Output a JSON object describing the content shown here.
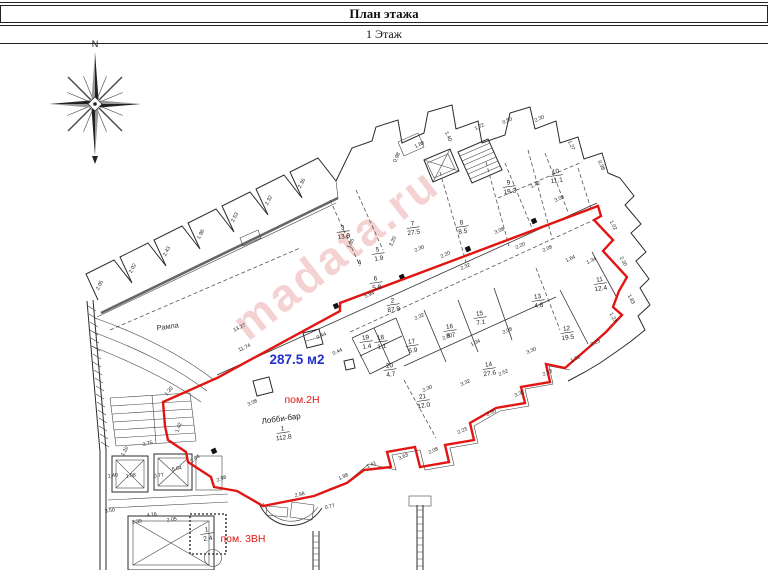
{
  "header": {
    "title": "План этажа",
    "subtitle": "1 Этаж"
  },
  "compass": {
    "north_label": "N"
  },
  "watermark": {
    "text": "madata.ru",
    "color": "rgba(226,118,118,0.33)"
  },
  "highlight": {
    "area_label": "287.5 м2",
    "area_color": "#2431c9",
    "outline_color": "#e11612",
    "label_color": "#e11612",
    "premise_label": "пом.2Н",
    "premise3_label": "пом. 3ВН"
  },
  "plan": {
    "ramp_label": "Рампа",
    "rooms": [
      {
        "num": "1",
        "area": "112.8",
        "x": 283,
        "y": 432,
        "label": "Лобби-бар"
      },
      {
        "num": "2",
        "area": "87.9",
        "x": 393,
        "y": 304
      },
      {
        "num": "3",
        "area": "13.9",
        "x": 343,
        "y": 231
      },
      {
        "num": "4",
        "area": "",
        "x": 360,
        "y": 266
      },
      {
        "num": "5",
        "area": "1.9",
        "x": 378,
        "y": 253
      },
      {
        "num": "6",
        "area": "5.8",
        "x": 376,
        "y": 282
      },
      {
        "num": "7",
        "area": "27.5",
        "x": 413,
        "y": 227
      },
      {
        "num": "8",
        "area": "8.5",
        "x": 462,
        "y": 226
      },
      {
        "num": "9",
        "area": "19.3",
        "x": 509,
        "y": 186
      },
      {
        "num": "10",
        "area": "11.1",
        "x": 556,
        "y": 175
      },
      {
        "num": "11",
        "area": "12.4",
        "x": 600,
        "y": 283
      },
      {
        "num": "12",
        "area": "19.5",
        "x": 567,
        "y": 332
      },
      {
        "num": "13",
        "area": "4.8",
        "x": 538,
        "y": 300
      },
      {
        "num": "14",
        "area": "27.6",
        "x": 489,
        "y": 368
      },
      {
        "num": "15",
        "area": "7.1",
        "x": 480,
        "y": 317
      },
      {
        "num": "16",
        "area": "8.7",
        "x": 450,
        "y": 330
      },
      {
        "num": "17",
        "area": "6.9",
        "x": 412,
        "y": 345
      },
      {
        "num": "18",
        "area": "1.1",
        "x": 381,
        "y": 341
      },
      {
        "num": "19",
        "area": "1.4",
        "x": 366,
        "y": 341
      },
      {
        "num": "20",
        "area": "4.7",
        "x": 390,
        "y": 369
      },
      {
        "num": "21",
        "area": "12.0",
        "x": 423,
        "y": 400
      },
      {
        "num": "1",
        "area": "2.4",
        "x": 207,
        "y": 533
      }
    ],
    "dims": [
      [
        101,
        286,
        "2.05",
        -62
      ],
      [
        134,
        269,
        "2.02",
        -62
      ],
      [
        168,
        252,
        "2.43",
        -62
      ],
      [
        202,
        235,
        "1.98",
        -62
      ],
      [
        236,
        218,
        "2.53",
        -62
      ],
      [
        270,
        201,
        "2.32",
        -62
      ],
      [
        303,
        184,
        "2.36",
        -62
      ],
      [
        240,
        329,
        "13.27",
        -25
      ],
      [
        245,
        349,
        "11.74",
        -25
      ],
      [
        370,
        296,
        "5.94",
        -25
      ],
      [
        322,
        337,
        "0.44",
        -25
      ],
      [
        338,
        353,
        "0.44",
        -25
      ],
      [
        253,
        404,
        "3.08",
        -25
      ],
      [
        352,
        244,
        "1.35",
        -65
      ],
      [
        394,
        242,
        "3.20",
        -65
      ],
      [
        420,
        250,
        "2.30",
        -25
      ],
      [
        446,
        256,
        "2.20",
        -25
      ],
      [
        466,
        268,
        "2.32",
        -25
      ],
      [
        500,
        232,
        "3.08",
        -25
      ],
      [
        521,
        247,
        "2.20",
        -25
      ],
      [
        548,
        250,
        "2.08",
        -25
      ],
      [
        571,
        260,
        "1.64",
        -25
      ],
      [
        592,
        262,
        "1.34",
        -25
      ],
      [
        398,
        158,
        "0.98",
        -65
      ],
      [
        420,
        146,
        "1.88",
        -25
      ],
      [
        447,
        137,
        "1.40",
        65
      ],
      [
        480,
        128,
        "1.72",
        -25
      ],
      [
        508,
        122,
        "0.50",
        -25
      ],
      [
        540,
        120,
        "2.30",
        -25
      ],
      [
        570,
        146,
        "1.27",
        65
      ],
      [
        600,
        166,
        "0.98",
        65
      ],
      [
        560,
        200,
        "3.08",
        -25
      ],
      [
        536,
        186,
        "1.42",
        -25
      ],
      [
        612,
        226,
        "1.02",
        62
      ],
      [
        622,
        262,
        "2.30",
        62
      ],
      [
        630,
        300,
        "1.83",
        62
      ],
      [
        612,
        318,
        "1.23",
        62
      ],
      [
        596,
        344,
        "2.23",
        -25
      ],
      [
        576,
        360,
        "1.61",
        -25
      ],
      [
        548,
        374,
        "2.53",
        -25
      ],
      [
        520,
        395,
        "3.32",
        -25
      ],
      [
        492,
        414,
        "2.50",
        -25
      ],
      [
        463,
        432,
        "2.23",
        -25
      ],
      [
        434,
        452,
        "2.08",
        -25
      ],
      [
        404,
        458,
        "3.63",
        -25
      ],
      [
        372,
        466,
        "1.41",
        -25
      ],
      [
        344,
        478,
        "1.98",
        -25
      ],
      [
        300,
        496,
        "2.98",
        -12
      ],
      [
        330,
        508,
        "0.77",
        -12
      ],
      [
        110,
        512,
        "3.50",
        -8
      ],
      [
        152,
        516,
        "4.16",
        -8
      ],
      [
        137,
        523,
        "1.39",
        -8
      ],
      [
        172,
        521,
        "2.05",
        -8
      ],
      [
        177,
        470,
        "6.04",
        -8
      ],
      [
        131,
        477,
        "1.08",
        -8
      ],
      [
        113,
        477,
        "1.40",
        -8
      ],
      [
        159,
        477,
        "0.77",
        -8
      ],
      [
        126,
        452,
        "1.20",
        -60
      ],
      [
        148,
        445,
        "3.75",
        -15
      ],
      [
        170,
        392,
        "1.20",
        -50
      ],
      [
        180,
        428,
        "1.42",
        -70
      ],
      [
        196,
        460,
        "2.04",
        -35
      ],
      [
        222,
        480,
        "2.98",
        -22
      ],
      [
        420,
        318,
        "2.32",
        -25
      ],
      [
        448,
        338,
        "2.30",
        -25
      ],
      [
        476,
        344,
        "1.34",
        -25
      ],
      [
        508,
        332,
        "2.08",
        -25
      ],
      [
        532,
        352,
        "3.30",
        -25
      ],
      [
        466,
        384,
        "3.32",
        -25
      ],
      [
        504,
        374,
        "2.52",
        -25
      ],
      [
        428,
        390,
        "2.30",
        -25
      ]
    ]
  }
}
